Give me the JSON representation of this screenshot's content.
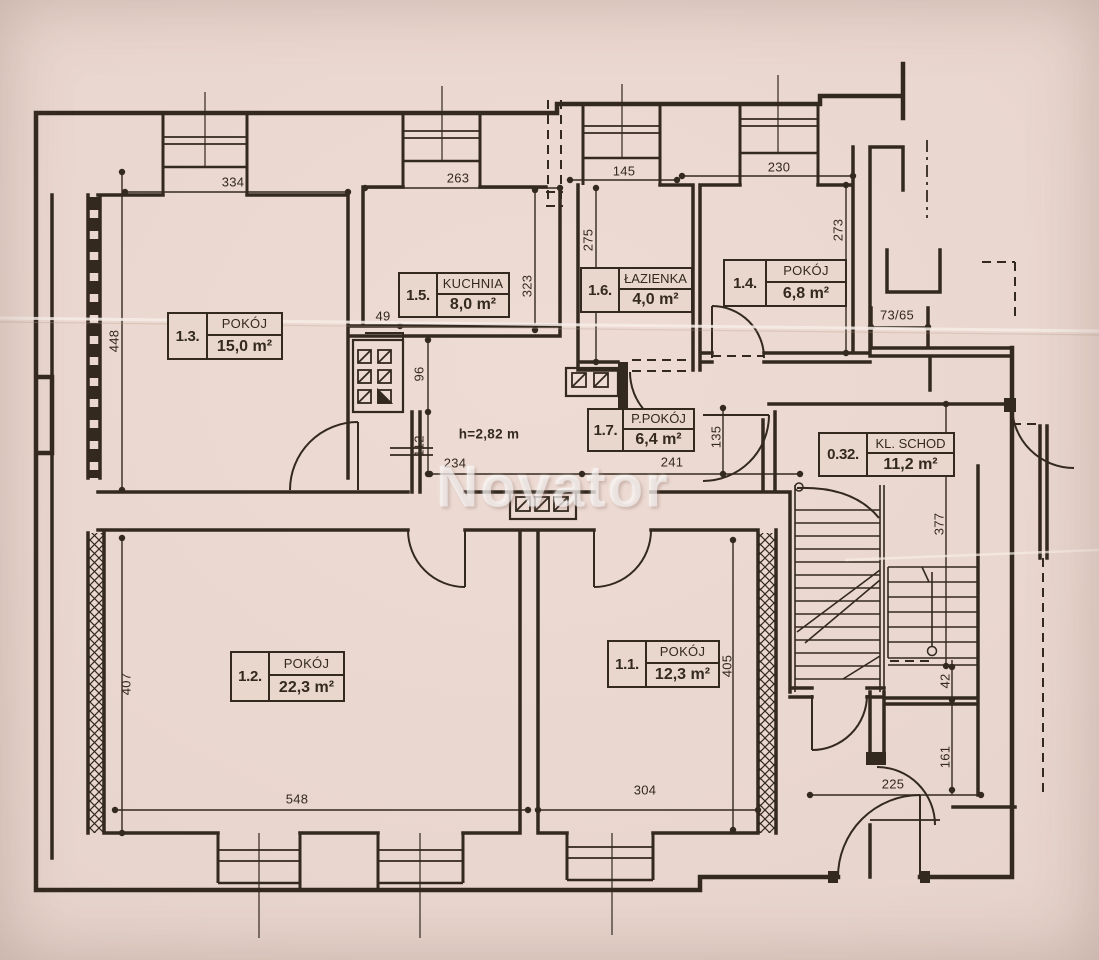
{
  "watermark": "Novator",
  "rooms": [
    {
      "id": "1.3.",
      "name": "POKÓJ",
      "area": "15,0 m²"
    },
    {
      "id": "1.5.",
      "name": "KUCHNIA",
      "area": "8,0 m²"
    },
    {
      "id": "1.6.",
      "name": "ŁAZIENKA",
      "area": "4,0 m²"
    },
    {
      "id": "1.4.",
      "name": "POKÓJ",
      "area": "6,8 m²"
    },
    {
      "id": "1.7.",
      "name": "P.POKÓJ",
      "area": "6,4 m²"
    },
    {
      "id": "0.32.",
      "name": "KL. SCHOD",
      "area": "11,2 m²"
    },
    {
      "id": "1.2.",
      "name": "POKÓJ",
      "area": "22,3 m²"
    },
    {
      "id": "1.1.",
      "name": "POKÓJ",
      "area": "12,3 m²"
    }
  ],
  "dimensions": {
    "d334": "334",
    "d263": "263",
    "d145": "145",
    "d230": "230",
    "d448": "448",
    "d323": "323",
    "d275": "275",
    "d273": "273",
    "d49": "49",
    "d96": "96",
    "d112": "112",
    "d234": "234",
    "d241": "241",
    "d135": "135",
    "d377": "377",
    "d405": "405",
    "d407": "407",
    "d548": "548",
    "d304": "304",
    "d225": "225",
    "d161": "161",
    "d42": "42",
    "d7365": "73/65"
  },
  "annotations": {
    "ceiling_height": "h=2,82 m"
  },
  "colors": {
    "paper": "#e8d6cc",
    "ink": "#33291f",
    "watermark": "#ffffff"
  }
}
